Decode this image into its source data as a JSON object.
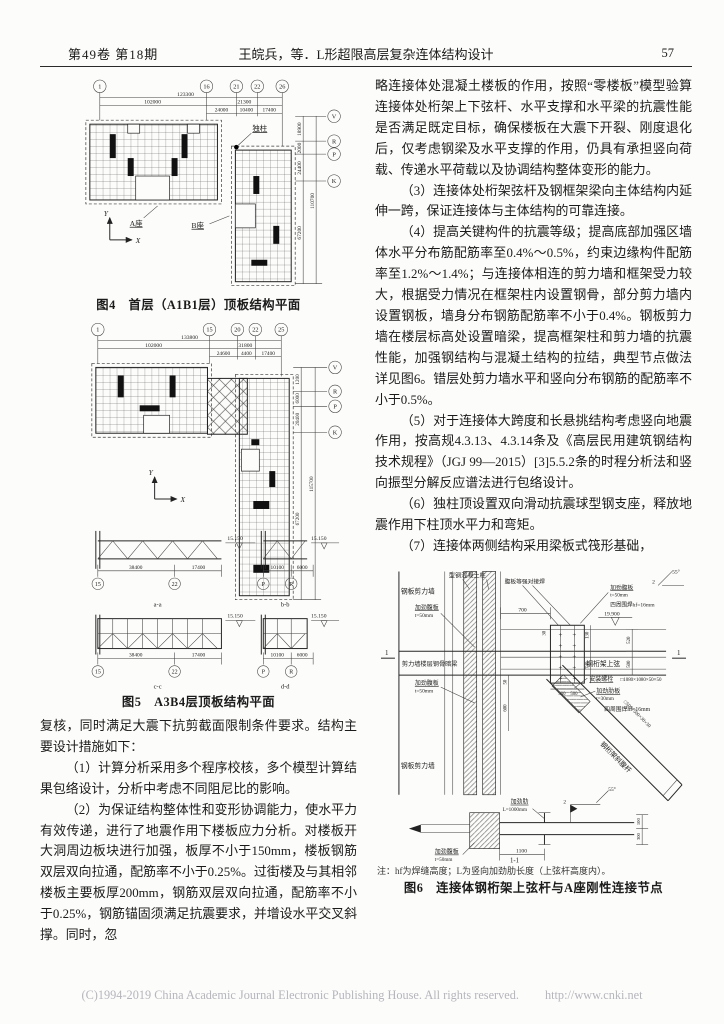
{
  "header": {
    "issue": "第49卷 第18期",
    "title": "王皖兵，等．L形超限高层复杂连体结构设计",
    "page": "57"
  },
  "footer": {
    "copyright": "(C)1994-2019 China Academic Journal Electronic Publishing House. All rights reserved.",
    "url": "http://www.cnki.net"
  },
  "left": {
    "paragraphs": [
      "复核，同时满足大震下抗剪截面限制条件要求。结构主要设计措施如下：",
      "（1）计算分析采用多个程序校核，多个模型计算结果包络设计，分析中考虑不同阻尼比的影响。",
      "（2）为保证结构整体性和变形协调能力，使水平力有效传递，进行了地震作用下楼板应力分析。对楼板开大洞周边板块进行加强，板厚不小于150mm，楼板钢筋双层双向拉通，配筋率不小于0.25%。过街楼及与其相邻楼板主要板厚200mm，钢筋双层双向拉通，配筋率不小于0.25%，钢筋锚固须满足抗震要求，并增设水平交叉斜撑。同时，忽"
    ]
  },
  "right": {
    "paragraphs": [
      "略连接体处混凝土楼板的作用，按照“零楼板”模型验算连接体处桁架上下弦杆、水平支撑和水平梁的抗震性能是否满足既定目标，确保楼板在大震下开裂、刚度退化后，仅考虑钢梁及水平支撑的作用，仍具有承担竖向荷载、传递水平荷载以及协调结构整体变形的能力。",
      "（3）连接体处桁架弦杆及钢框架梁向主体结构内延伸一跨，保证连接体与主体结构的可靠连接。",
      "（4）提高关键构件的抗震等级；提高底部加强区墙体水平分布筋配筋率至0.4%～0.5%，约束边缘构件配筋率至1.2%～1.4%；与连接体相连的剪力墙和框架受力较大，根据受力情况在框架柱内设置钢骨，部分剪力墙内设置钢板，墙身分布钢筋配筋率不小于0.4%。钢板剪力墙在楼层标高处设置暗梁，提高框架柱和剪力墙的抗震性能，加强钢结构与混凝土结构的拉结，典型节点做法详见图6。错层处剪力墙水平和竖向分布钢筋的配筋率不小于0.5%。",
      "（5）对于连接体大跨度和长悬挑结构考虑竖向地震作用，按高规4.3.13、4.3.14条及《高层民用建筑钢结构技术规程》（JGJ 99—2015）[3]5.5.2条的时程分析法和竖向振型分解反应谱法进行包络设计。",
      "（6）独柱顶设置双向滑动抗震球型钢支座，释放地震作用下柱顶水平力和弯矩。",
      "（7）连接体两侧结构采用梁板式筏形基础，"
    ]
  },
  "fig4": {
    "caption": "图4　首层（A1B1层）顶板结构平面",
    "bubbles": {
      "t1": "1",
      "t2": "16",
      "t3": "21",
      "t4": "22",
      "t5": "26",
      "r1": "V",
      "r2": "R",
      "r3": "P",
      "r4": "K"
    },
    "dims": {
      "total": "123300",
      "left": "102000",
      "right": "21300",
      "s1": "24000",
      "s2": "10400",
      "s3": "17400",
      "v1": "18900",
      "v2": "2000",
      "v3": "24400",
      "v4": "67200",
      "v5": "110700"
    },
    "labels": {
      "single_column": "独柱",
      "block_a": "A座",
      "block_b": "B座",
      "axis_x": "X",
      "axis_y": "Y"
    }
  },
  "fig5": {
    "caption": "图5　A3B4层顶板结构平面",
    "bubbles": {
      "t1": "1",
      "t2": "15",
      "t3": "20",
      "t4": "22",
      "t5": "25",
      "r1": "V",
      "r2": "R",
      "r3": "P",
      "r4": "K",
      "s15": "15",
      "s22": "22",
      "sp": "P",
      "sr": "R"
    },
    "dims": {
      "total": "133800",
      "left": "102000",
      "right": "31800",
      "s1": "24600",
      "s2": "4400",
      "s3": "17400",
      "v1": "1200",
      "v2": "6000",
      "v3": "20400",
      "v4": "67200",
      "v5": "115700",
      "e1": "38400",
      "e2": "17400",
      "e3": "10100",
      "e4": "6000"
    },
    "labels": {
      "axis_x": "X",
      "axis_y": "Y",
      "elev": "15.150",
      "sa": "a-a",
      "sb": "b-b",
      "sc": "c-c",
      "sd": "d-d"
    }
  },
  "fig6": {
    "caption": "图6　连接体钢桁架上弦杆与A座刚性连接节点",
    "note": "注：hf为焊缝高度；L为竖向加劲肋长度（上弦杆高度内）。",
    "labels": {
      "steel_plate_wall": "钢板剪力墙",
      "src_column": "型钢混凝土柱",
      "web_butt_weld": "腹板等强对接焊",
      "stiff_web": "加劲腹板",
      "t50": "t=50mm",
      "hidden_beam": "剪力墙楼层钢骨暗梁",
      "perimeter_weld": "四周围焊hf=16mm",
      "elev": "19.900",
      "top_chord": "钢桁架上弦",
      "install_bolts": "安装螺栓",
      "box1080": "□1080×1080×50×50",
      "stiff_rib_plate": "加劲肋板",
      "t30": "t=30mm",
      "box500": "□500×500×30×30",
      "diagonal": "钢桁架斜腹杆",
      "stiff_rib": "加劲肋",
      "l1000": "L=1000mm",
      "sec_mark": "1",
      "sec_name": "1-1",
      "deg": "55°",
      "two": "2"
    },
    "dims": {
      "d700": "700",
      "d130": "130",
      "d740": "740",
      "d500": "500",
      "d520": "520",
      "d600": "600",
      "d50": "50",
      "d30": "30",
      "d1100": "1100",
      "d100": "100",
      "d300": "300"
    }
  }
}
